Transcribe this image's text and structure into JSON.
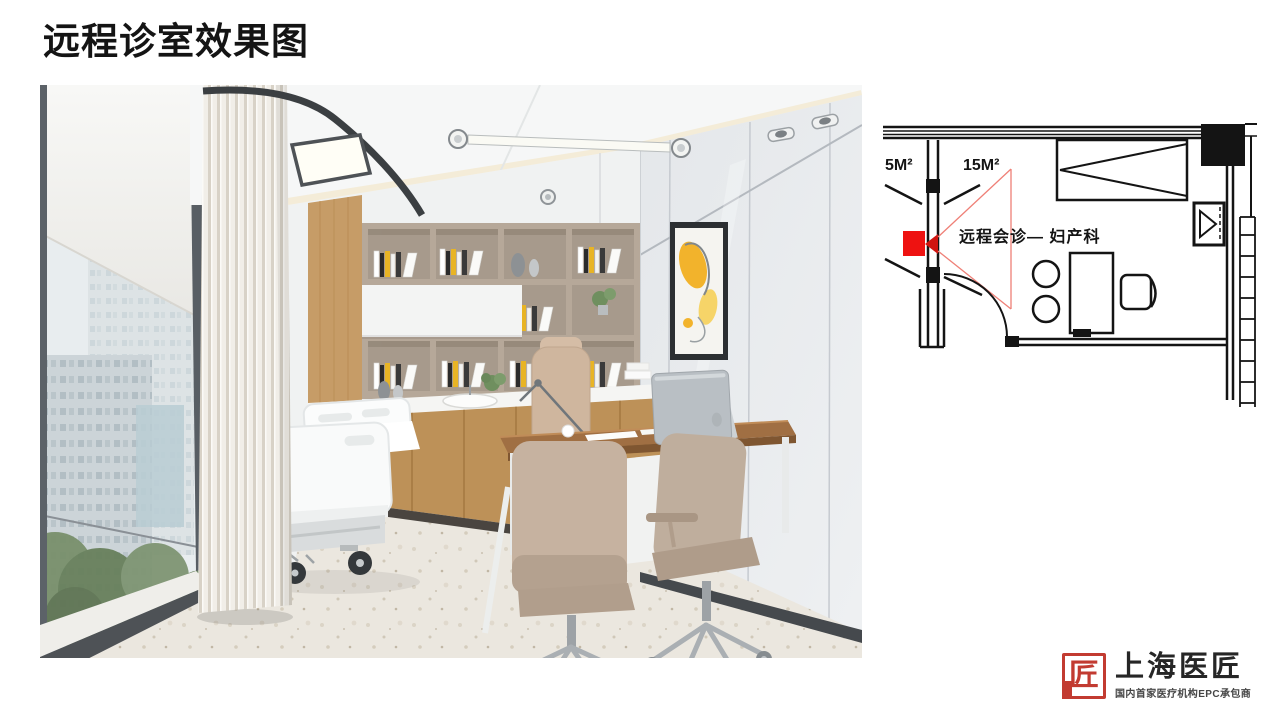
{
  "slide": {
    "title": "远程诊室效果图"
  },
  "floor_plan": {
    "labels": {
      "left_area": "5M²",
      "room_area": "15M²",
      "room_name": "远程会诊— 妇产科"
    },
    "colors": {
      "line": "#141414",
      "camera_marker": "#ee1211",
      "view_cone": "#ef8077"
    }
  },
  "logo": {
    "seal_char": "匠",
    "name": "上海医匠",
    "tagline": "国内首家医疗机构EPC承包商",
    "seal_color": "#c23b31"
  }
}
